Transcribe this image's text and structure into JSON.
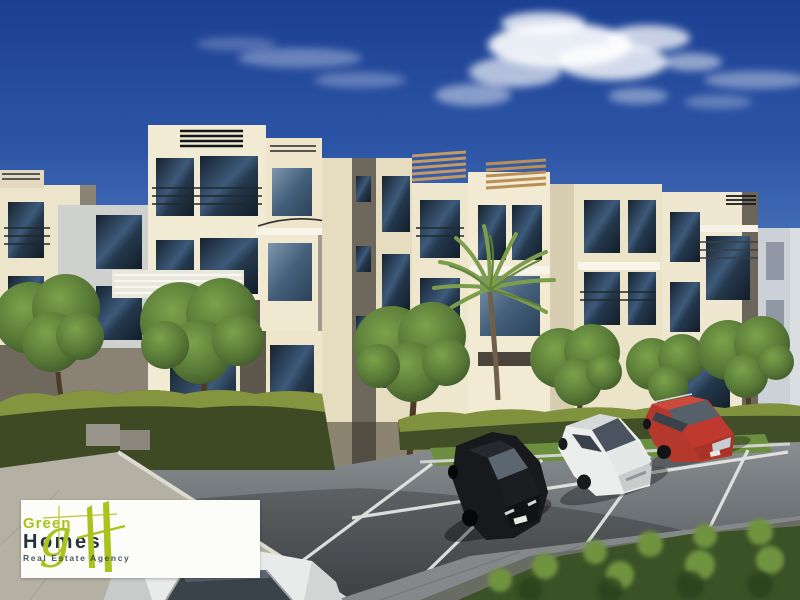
{
  "image": {
    "description": "3D architectural rendering of a modern cream-colored apartment complex under a deep blue sky with clouds; round trees, hedges and a palm tree line the facade; a black sedan, a white sedan and a red SUV are parked diagonally in the foreground parking lot; a white car roof enters the bottom edge; a Green Homes real-estate watermark sits bottom-left."
  },
  "logo": {
    "monogram_g": "g",
    "line1": "Green",
    "line2": "Homes",
    "tagline": "Real Estate Agency",
    "colors": {
      "lime": "#a9c21d",
      "dark": "#24323e",
      "background": "#fcfcf9"
    }
  },
  "palette": {
    "sky_top": "#1b3f92",
    "sky_mid": "#3a63b0",
    "sky_horizon": "#9db1d4",
    "cloud": "#ffffff",
    "facade_cream": "#f2ebd4",
    "facade_shaded": "#e3dabd",
    "facade_taupe": "#6e675b",
    "glass_dark": "#1c2b3a",
    "glass_reflect": "#5d7da0",
    "pergola_wood": "#c49a62",
    "parapet_slat": "#15171a",
    "tree_green": "#5f8040",
    "hedge_dark": "#3d4a24",
    "hedge_lit": "#8d9d42",
    "lawn": "#6b8f3f",
    "asphalt": "#75797d",
    "sidewalk": "#b4b0a3",
    "marking": "#e8e9e6",
    "car_black": "#121416",
    "car_white": "#eceeed",
    "car_red": "#b5382d"
  }
}
